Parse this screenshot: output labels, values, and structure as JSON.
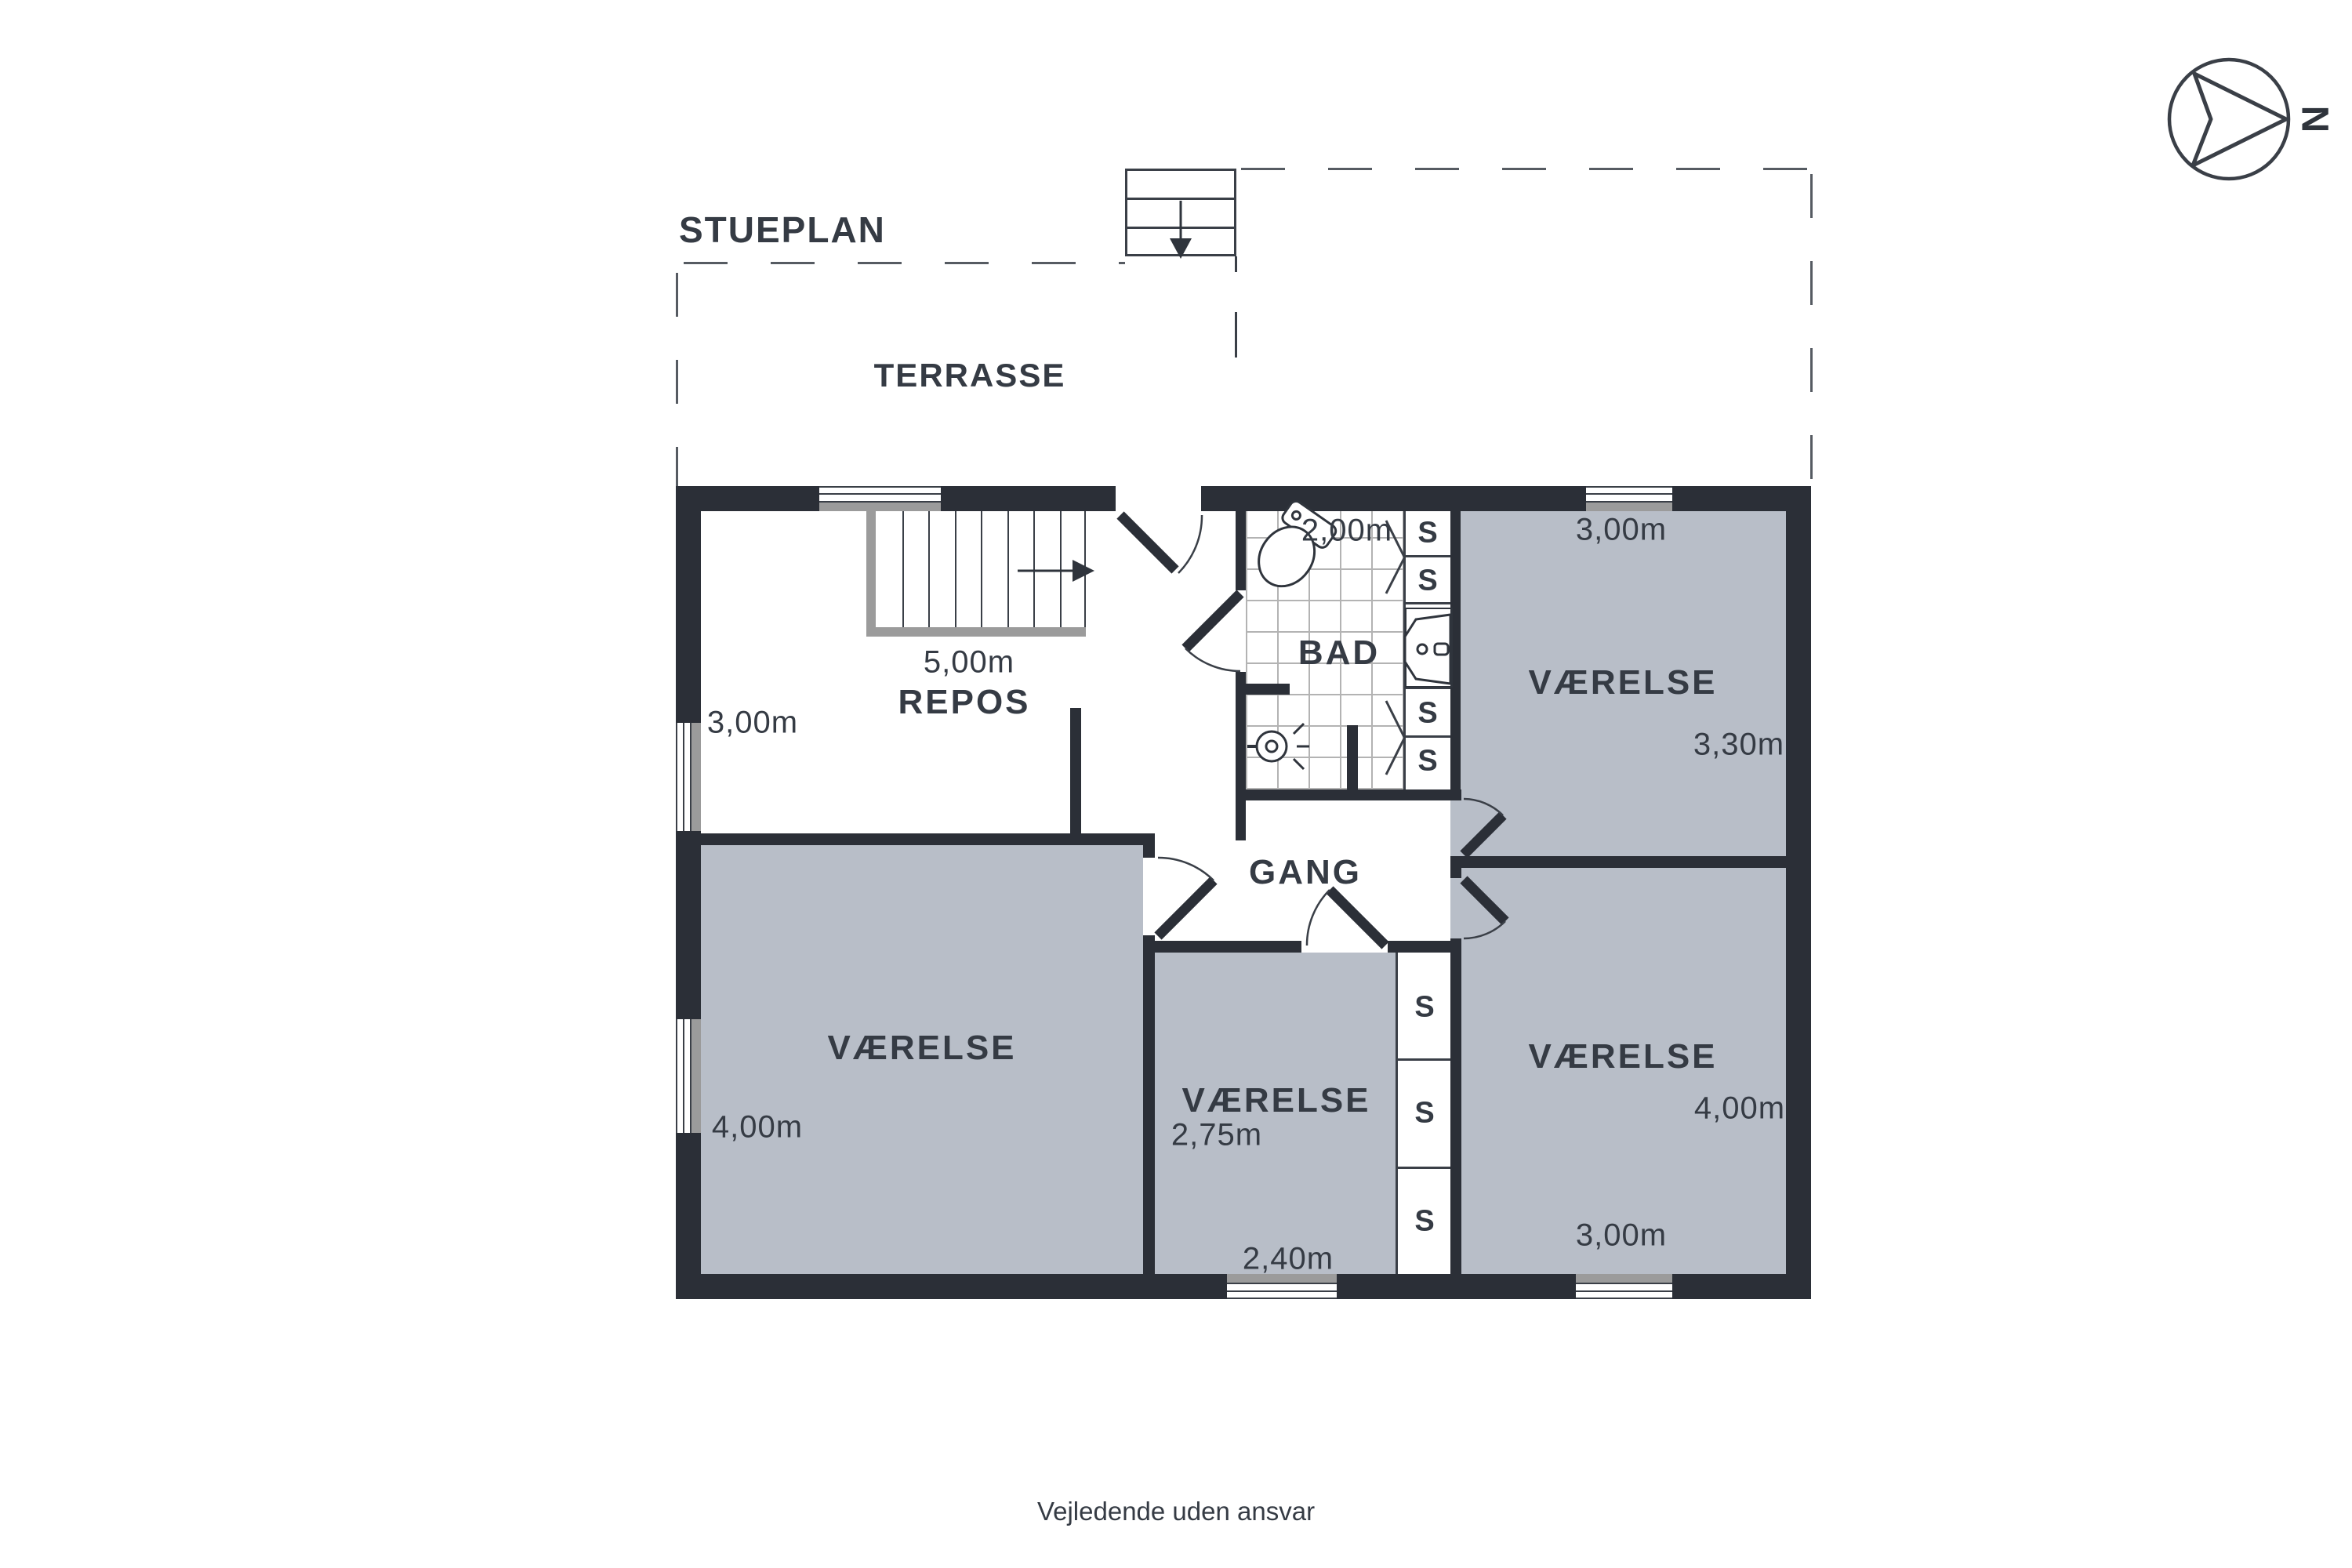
{
  "title": "STUEPLAN",
  "compass": {
    "letter": "N"
  },
  "terrace": {
    "label": "TERRASSE"
  },
  "rooms": {
    "repos": {
      "name": "REPOS",
      "dim_stairs": "5,00m",
      "dim_left": "3,00m"
    },
    "bad": {
      "name": "BAD",
      "dim_top": "2,00m"
    },
    "gang": {
      "name": "GANG"
    },
    "vaerelse_ne": {
      "name": "VÆRELSE",
      "dim_top": "3,00m",
      "dim_right": "3,30m"
    },
    "vaerelse_sw": {
      "name": "VÆRELSE",
      "dim_left": "4,00m"
    },
    "vaerelse_s": {
      "name": "VÆRELSE",
      "dim_left": "2,75m",
      "dim_bottom": "2,40m"
    },
    "vaerelse_se": {
      "name": "VÆRELSE",
      "dim_right": "4,00m",
      "dim_bottom": "3,00m"
    }
  },
  "closets": {
    "label": "S"
  },
  "disclaimer": "Vejledende uden ansvar",
  "colors": {
    "wall": "#2b2f37",
    "room_fill": "#b8bec8",
    "sill_gray": "#9b9b9b",
    "text": "#353b44"
  }
}
